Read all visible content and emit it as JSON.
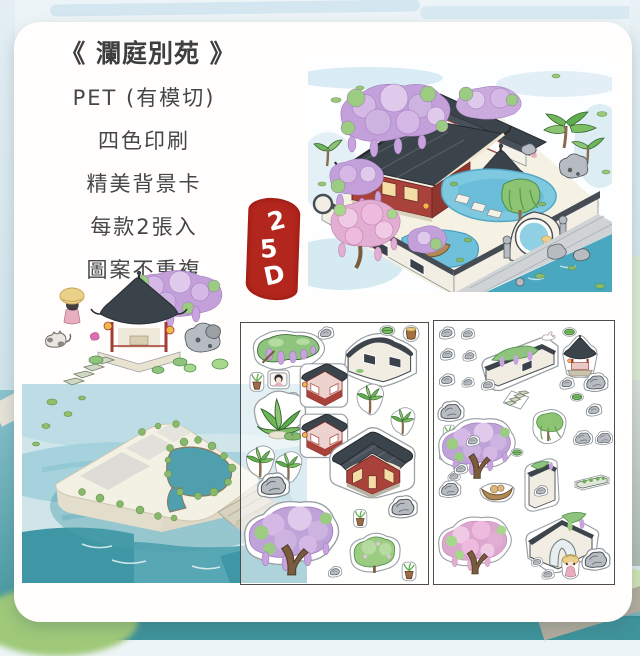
{
  "card": {
    "title": "《 瀾庭別苑 》",
    "features": [
      "PET (有模切)",
      "四色印刷",
      "精美背景卡",
      "每款2張入",
      "圖案不重複"
    ],
    "seal": {
      "label": "2.5D",
      "chars": [
        "2",
        "5",
        "D"
      ],
      "color": "#b2261d"
    }
  },
  "images": {
    "garden_scene": "isometric-garden-illustration",
    "pavilion_vignette": "pavilion-with-girl-and-cat-illustration",
    "background_card": "watercolor-island-background-card",
    "sticker_sheet_1": "die-cut-sticker-sheet",
    "sticker_sheet_2": "die-cut-sticker-sheet"
  },
  "colors": {
    "seal_red": "#b2261d",
    "roof_dark": "#3b434b",
    "wisteria_purple": "#c9a3dd",
    "pond_blue": "#7ec9e0",
    "teal_backdrop": "#3f939b"
  }
}
